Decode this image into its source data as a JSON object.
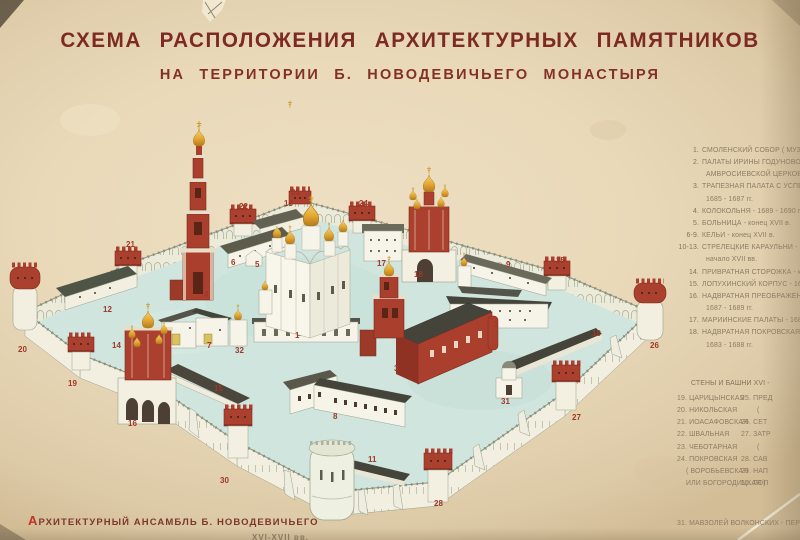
{
  "title": {
    "line1": "СХЕМА РАСПОЛОЖЕНИЯ АРХИТЕКТУРНЫХ ПАМЯТНИКОВ",
    "line2": "НА ТЕРРИТОРИИ Б. НОВОДЕВИЧЬЕГО МОНАСТЫРЯ"
  },
  "caption": {
    "initial": "А",
    "rest": "РХИТЕКТУРНЫЙ АНСАМБЛЬ Б. НОВОДЕВИЧЬЕГО",
    "fragment_line2": "XVI-XVII вв."
  },
  "legend": {
    "rows": [
      {
        "n": "1.",
        "t": "СМОЛЕНСКИЙ СОБОР ( МУЗЕЙ ) - 152"
      },
      {
        "n": "2.",
        "t": "ПАЛАТЫ ИРИНЫ ГОДУНОВОЙ С ТРА"
      },
      {
        "t": "АМВРОСИЕВСКОЙ ЦЕРКОВЬЮ -"
      },
      {
        "n": "3.",
        "t": "ТРАПЕЗНАЯ ПАЛАТА С УСПЕНСКОЙ"
      },
      {
        "t": "1685 - 1687 гг."
      },
      {
        "n": "4.",
        "t": "КОЛОКОЛЬНЯ - 1689 - 1690 гг."
      },
      {
        "n": "5.",
        "t": "БОЛЬНИЦА - конец XVII в."
      },
      {
        "n": "6-9.",
        "t": "КЕЛЬИ - конец XVII в."
      },
      {
        "n": "10-13.",
        "t": "СТРЕЛЕЦКИЕ КАРАУЛЬНИ - к"
      },
      {
        "t": "начало XVII вв."
      },
      {
        "n": "14.",
        "t": "ПРИВРАТНАЯ СТОРОЖКА - кон"
      },
      {
        "n": "15.",
        "t": "ЛОПУХИНСКИЙ КОРПУС - 1687-1"
      },
      {
        "n": "16.",
        "t": "НАДВРАТНАЯ ПРЕОБРАЖЕНСКАЯ"
      },
      {
        "t": "1687 - 1689 гг."
      },
      {
        "n": "17.",
        "t": "МАРИИНСКИЕ ПАЛАТЫ - 1683 -"
      },
      {
        "n": "18.",
        "t": "НАДВРАТНАЯ ПОКРОВСКАЯ ЦЕР"
      },
      {
        "t": "1683 - 1688 гг."
      }
    ],
    "towers_header": "СТЕНЫ И БАШНИ XVI -",
    "towers_col1": [
      "19. ЦАРИЦЫНСКАЯ",
      "20. НИКОЛЬСКАЯ",
      "21. ИОАСАФОВСКАЯ",
      "22. ШВАЛЬНАЯ",
      "23. ЧЕБОТАРНАЯ",
      "24. ПОКРОВСКАЯ",
      "( ВОРОБЬЕВСКАЯ",
      "ИЛИ БОГОРОДИЦКАЯ )"
    ],
    "towers_col2": [
      "25. ПРЕД",
      "(",
      "26. СЕТ",
      "27. ЗАТР",
      "(",
      "28. САВ",
      "29. НАП",
      "30. ЛОП"
    ],
    "mausoleum": "31. МАВЗОЛЕЙ ВОЛКОНСКИХ - ПЕР"
  },
  "map_labels": [
    {
      "n": "1",
      "x": 295,
      "y": 338
    },
    {
      "n": "2",
      "x": 494,
      "y": 327
    },
    {
      "n": "3",
      "x": 394,
      "y": 371
    },
    {
      "n": "4",
      "x": 204,
      "y": 297
    },
    {
      "n": "5",
      "x": 255,
      "y": 267
    },
    {
      "n": "6",
      "x": 231,
      "y": 265
    },
    {
      "n": "7",
      "x": 207,
      "y": 348
    },
    {
      "n": "8",
      "x": 333,
      "y": 419
    },
    {
      "n": "9",
      "x": 506,
      "y": 267
    },
    {
      "n": "10",
      "x": 592,
      "y": 336
    },
    {
      "n": "11",
      "x": 368,
      "y": 462
    },
    {
      "n": "12",
      "x": 103,
      "y": 312
    },
    {
      "n": "13",
      "x": 284,
      "y": 206
    },
    {
      "n": "14",
      "x": 112,
      "y": 348
    },
    {
      "n": "15",
      "x": 214,
      "y": 391
    },
    {
      "n": "16",
      "x": 128,
      "y": 426
    },
    {
      "n": "17",
      "x": 377,
      "y": 266
    },
    {
      "n": "18",
      "x": 414,
      "y": 277
    },
    {
      "n": "19",
      "x": 68,
      "y": 386
    },
    {
      "n": "20",
      "x": 18,
      "y": 352
    },
    {
      "n": "21",
      "x": 126,
      "y": 247
    },
    {
      "n": "22",
      "x": 239,
      "y": 209
    },
    {
      "n": "23",
      "x": 291,
      "y": 195
    },
    {
      "n": "24",
      "x": 359,
      "y": 206
    },
    {
      "n": "25",
      "x": 556,
      "y": 263
    },
    {
      "n": "26",
      "x": 650,
      "y": 348
    },
    {
      "n": "27",
      "x": 572,
      "y": 420
    },
    {
      "n": "28",
      "x": 434,
      "y": 506
    },
    {
      "n": "30",
      "x": 220,
      "y": 483
    },
    {
      "n": "31",
      "x": 501,
      "y": 404
    },
    {
      "n": "32",
      "x": 235,
      "y": 353
    }
  ],
  "colors": {
    "paper": "#e9dabd",
    "courtyard": "#cfe5de",
    "wall_white": "#f3f0e2",
    "brick_red": "#ac402f",
    "roof_dark": "#45443a",
    "dome_gold": "#d89a2b",
    "title_text": "#7c2a23",
    "legend_text": "#8d7c64",
    "map_number": "#9d3928"
  }
}
